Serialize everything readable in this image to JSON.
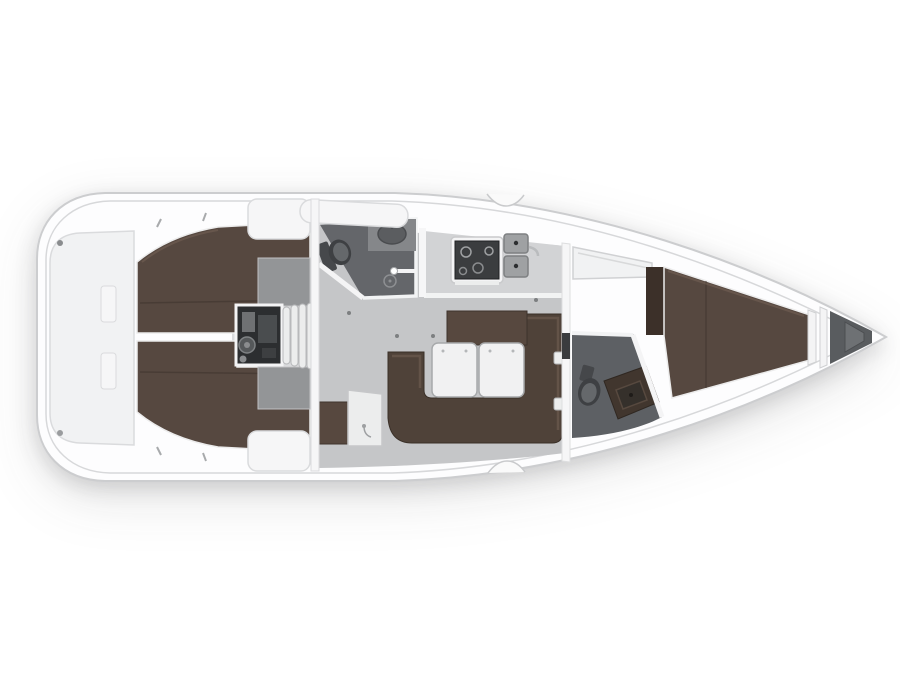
{
  "diagram": {
    "type": "sailboat-interior-floor-plan",
    "orientation": "bow-right",
    "regions": [
      {
        "id": "transom-platform",
        "label": "stern swim platform"
      },
      {
        "id": "aft-cabin-port",
        "label": "aft double berth port"
      },
      {
        "id": "aft-cabin-starboard",
        "label": "aft double berth starboard"
      },
      {
        "id": "engine-compartment",
        "label": "engine compartment"
      },
      {
        "id": "companionway-steps",
        "label": "companionway steps"
      },
      {
        "id": "aft-head",
        "label": "aft head with shower"
      },
      {
        "id": "galley",
        "label": "galley with stove and twin sinks"
      },
      {
        "id": "salon",
        "label": "salon with U-settee and folding table"
      },
      {
        "id": "nav-station",
        "label": "navigation seat and table"
      },
      {
        "id": "forward-head",
        "label": "forward head"
      },
      {
        "id": "forward-cabin",
        "label": "forward V-berth cabin"
      },
      {
        "id": "anchor-locker",
        "label": "bow anchor locker"
      }
    ]
  },
  "palette": {
    "hull": "#fdfdfe",
    "hullEdge": "#cccdcf",
    "deck": "#f1f2f3",
    "deckShade": "#dadbdd",
    "floor": "#c5c6c8",
    "counter": "#d2d3d5",
    "counterEdge": "#f2f3f3",
    "headFloor": "#64666a",
    "headFloorFwd": "#5d6064",
    "fixtureDark": "#3e4043",
    "fixtureMid": "#65686b",
    "fixtureGray": "#85878a",
    "basin": "#5b5d60",
    "berth": "#564840",
    "berthDark": "#41362e",
    "berthLight": "#6d5b4f",
    "settee": "#4f4239",
    "wood": "#57483f",
    "woodDark": "#3c3029",
    "white": "#f4f4f5",
    "lockerWhite": "#f6f6f7",
    "steel": "#9fa1a3",
    "engine": "#2c2e30",
    "engineBits": "#6f7173",
    "anchor": "#595c5f",
    "anchorStep": "#6e7174",
    "shelfGray": "#939597",
    "leaf": "#f1f1f2",
    "stoveTop": "#3b3d3f",
    "stepTread": "#eceded"
  }
}
